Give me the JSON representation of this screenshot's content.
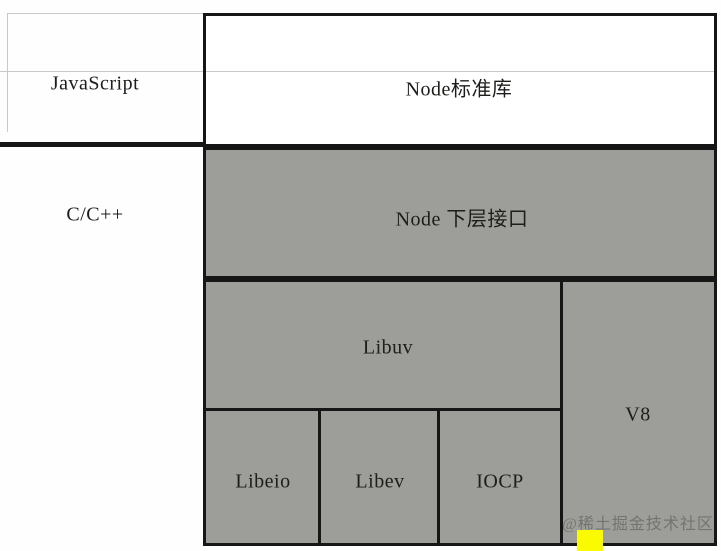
{
  "labels": {
    "javascript": "JavaScript",
    "c_cpp": "C/C++",
    "node_std": "Node标准库",
    "node_lower": "Node 下层接口",
    "libuv": "Libuv",
    "v8": "V8",
    "libeio": "Libeio",
    "libev": "Libev",
    "iocp": "IOCP",
    "watermark": "@稀土掘金技术社区"
  },
  "colors": {
    "gray_fill": "#9d9d99",
    "border": "#161616",
    "faint_line": "#c9c9c9",
    "yellow": "#fbfb00",
    "watermark": "#6e6e68",
    "text": "#1d1d1b",
    "background": "#fefefe"
  }
}
